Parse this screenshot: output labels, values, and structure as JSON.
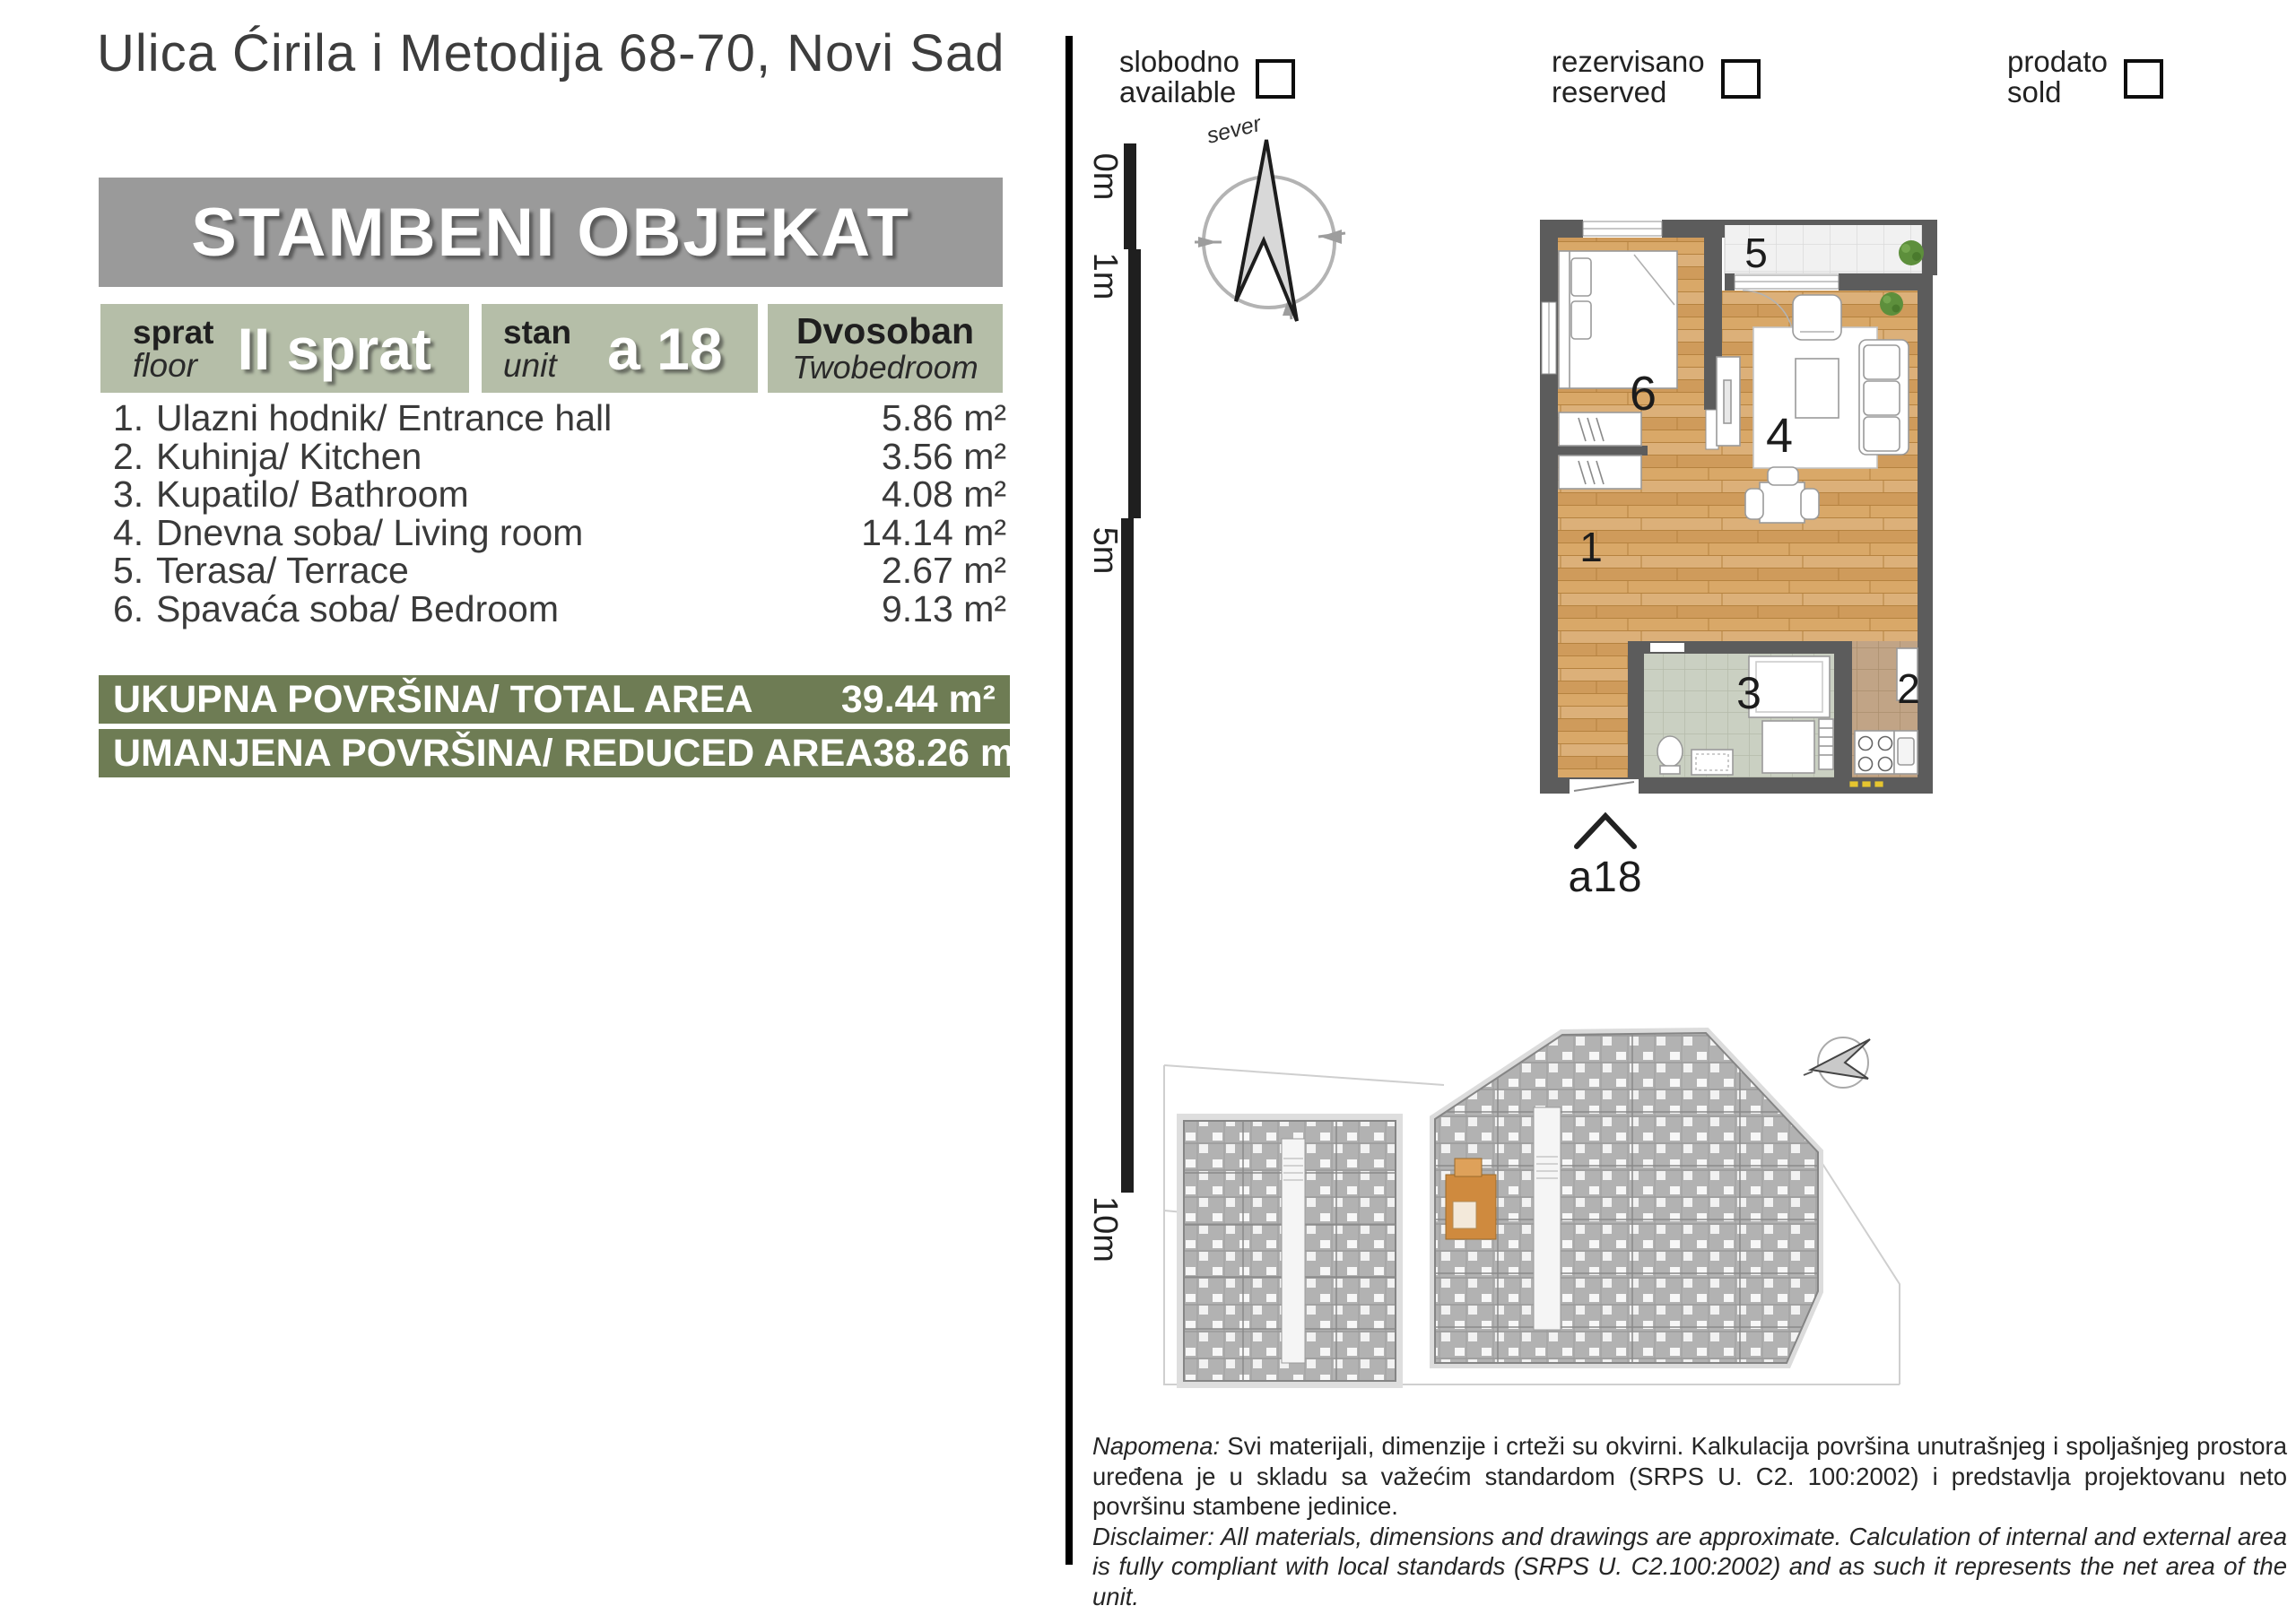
{
  "header": {
    "address": "Ulica Ćirila i Metodija 68-70, Novi Sad"
  },
  "banner": {
    "title": "STAMBENI OBJEKAT"
  },
  "badges": {
    "floor": {
      "label_sr": "sprat",
      "label_en": "floor",
      "value": "II sprat"
    },
    "unit": {
      "label_sr": "stan",
      "label_en": "unit",
      "value": "a 18"
    },
    "type": {
      "label_sr": "Dvosoban",
      "label_en": "Twobedroom"
    }
  },
  "rooms": [
    {
      "num": "1.",
      "name": "Ulazni hodnik/ Entrance hall",
      "area": "5.86 m²"
    },
    {
      "num": "2.",
      "name": "Kuhinja/ Kitchen",
      "area": "3.56 m²"
    },
    {
      "num": "3.",
      "name": "Kupatilo/ Bathroom",
      "area": "4.08 m²"
    },
    {
      "num": "4.",
      "name": "Dnevna soba/ Living room",
      "area": "14.14 m²"
    },
    {
      "num": "5.",
      "name": "Terasa/ Terrace",
      "area": "2.67 m²"
    },
    {
      "num": "6.",
      "name": "Spavaća soba/ Bedroom",
      "area": "9.13 m²"
    }
  ],
  "totals": [
    {
      "label": "UKUPNA POVRŠINA/ TOTAL AREA",
      "value": "39.44 m²"
    },
    {
      "label": "UMANJENA POVRŠINA/ REDUCED AREA",
      "value": "38.26 m²"
    }
  ],
  "legend": [
    {
      "sr": "slobodno",
      "en": "available"
    },
    {
      "sr": "rezervisano",
      "en": "reserved"
    },
    {
      "sr": "prodato",
      "en": "sold"
    }
  ],
  "compass": {
    "label": "sever"
  },
  "scale": {
    "labels": [
      "0m",
      "1m",
      "5m",
      "10m"
    ]
  },
  "plan": {
    "room_labels": {
      "r1": "1",
      "r2": "2",
      "r3": "3",
      "r4": "4",
      "r5": "5",
      "r6": "6"
    },
    "unit_tag": "a18"
  },
  "notes": {
    "napomena_label": "Napomena:",
    "napomena_text": " Svi materijali, dimenzije i crteži su okvirni. Kalkulacija površina unutrašnjeg i spoljašnjeg prostora uređena je u skladu sa važećim standardom (SRPS U. C2. 100:2002) i predstavlja projektovanu neto površinu stambene jedinice.",
    "disclaimer_label": "Disclaimer:",
    "disclaimer_text": " All materials, dimensions and drawings are approximate. Calculation of internal and external area is fully compliant with local standards (SRPS U. C2.100:2002) and as such it represents the net area of the unit."
  },
  "colors": {
    "sage": "#b5bea8",
    "olive": "#6e7c54",
    "banner_gray": "#9a9a9a",
    "wall": "#5c5c5c",
    "wood": "#d7a76c",
    "highlight_unit": "#cf8a3e"
  }
}
